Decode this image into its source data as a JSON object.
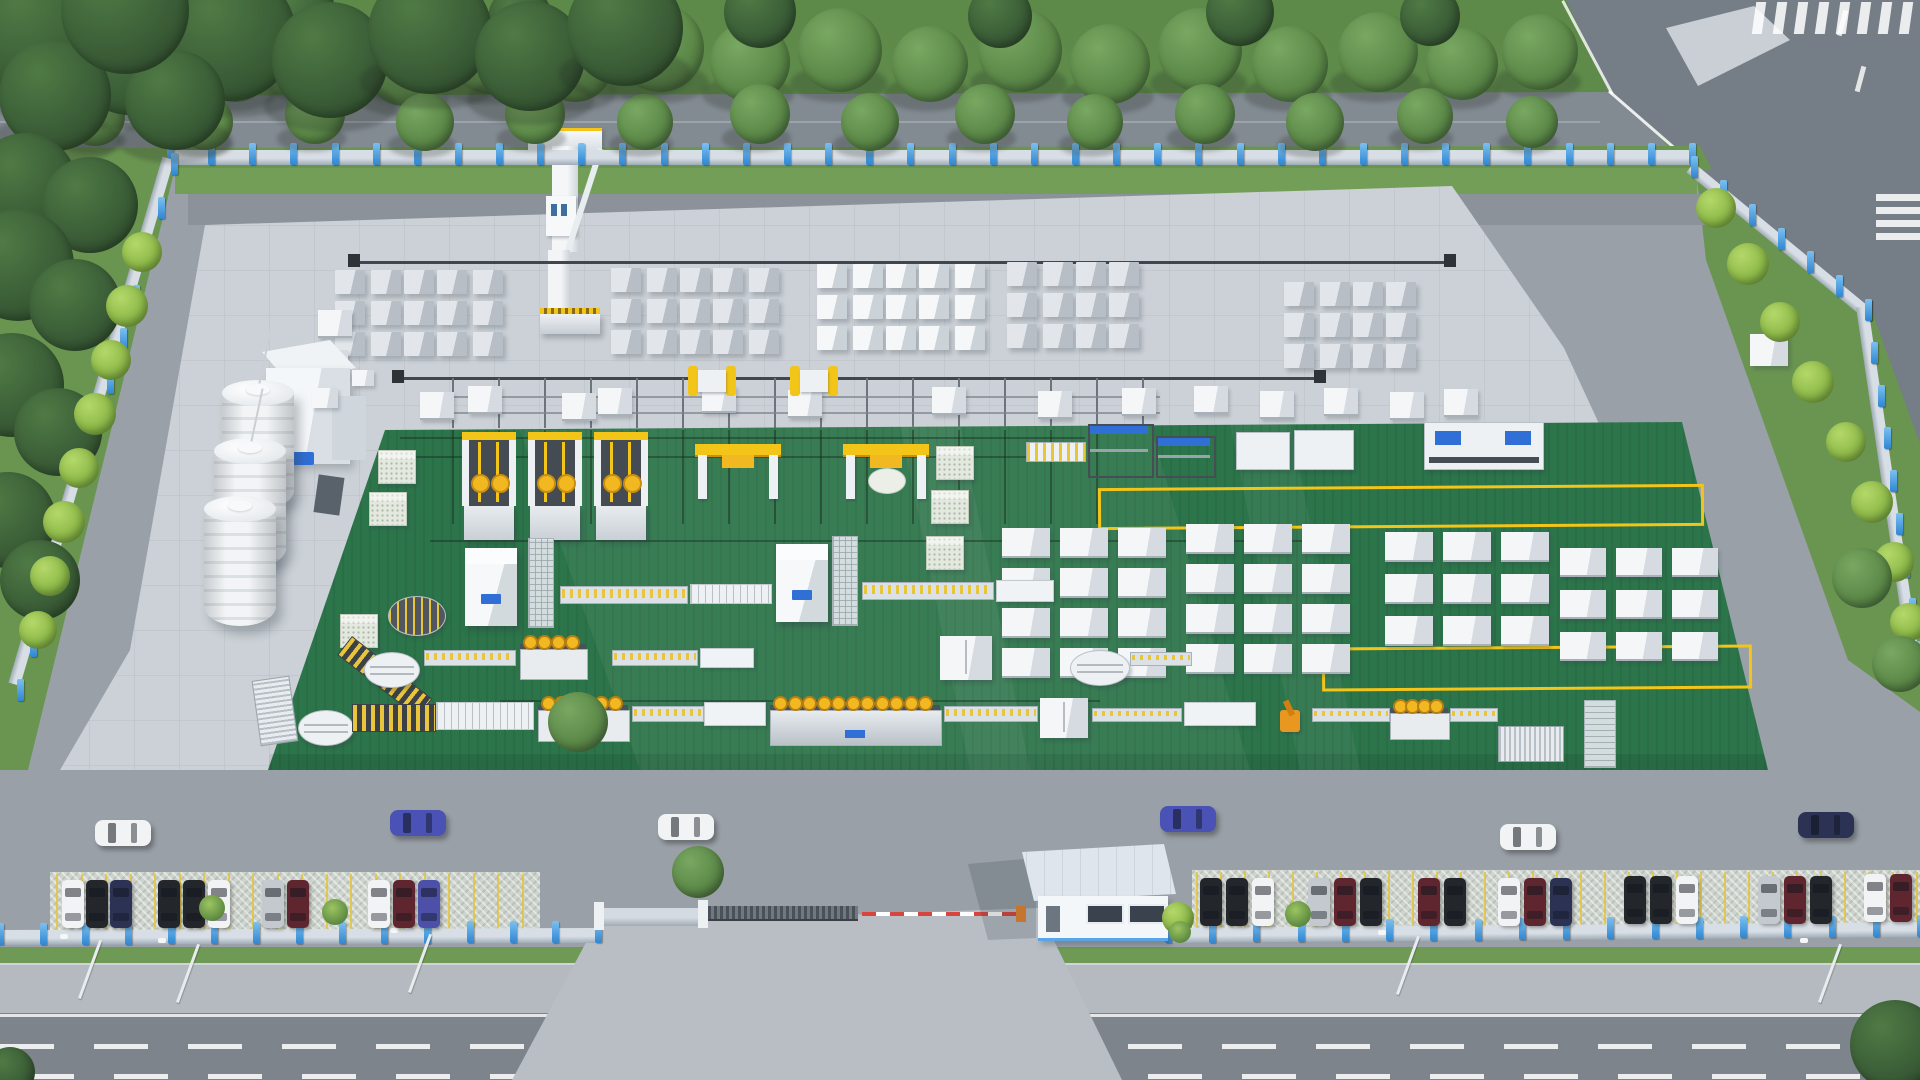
{
  "meta": {
    "description": "aerial 3d render of AAC block factory compound",
    "canvas": {
      "w": 1920,
      "h": 1080
    }
  },
  "palette": {
    "base_apron": "#99a0a7",
    "pad": "#cbd1d6",
    "inner_road": "#8b9299",
    "top_road": "#828a92",
    "wedge_road": "#757d86",
    "public_road": "#7d848c",
    "sidewalk": "#b4bac0",
    "driveway": "#b8bec4",
    "grass": "#6a9551",
    "grass_strip": "#739e57",
    "green_floor": "#2c744a",
    "green_stripe": "rgba(0,0,0,0.06)",
    "yellow": "#f2c518",
    "yellow_dark": "#c98f0e",
    "machine_white": "#eef1f4",
    "machine_side": "#c9d0d6",
    "block_gray_top": "#e2e6ea",
    "block_gray_side": "#b7bec6",
    "block_white_top": "#f5f7f8",
    "block_white_side": "#ccd3d8",
    "logo_blue": "#2f6fd6",
    "post_blue": "#3f98e2",
    "fence_wall": "#d3dae1",
    "dark_rail": "#41464c",
    "barrier_red": "#d8453e",
    "roof": "#dfe5ec",
    "tree": {
      "dark": {
        "l": "#4f7a45",
        "b": "#3b5e37",
        "e": "#2c472a"
      },
      "mid": {
        "l": "#79a862",
        "b": "#5d8a49",
        "e": "#44683a"
      },
      "bright": {
        "l": "#b4d86a",
        "b": "#8fbb4a",
        "e": "#6d9a3a"
      }
    },
    "car": {
      "white": "#f1f3f5",
      "black": "#23272c",
      "navy": "#2c3254",
      "silver": "#c3c9ce",
      "maroon": "#5f2630",
      "violet": "#4c50a8",
      "blue": "#4a52b5"
    }
  },
  "scene": {
    "trees": [
      [
        150,
        52,
        42,
        "mid"
      ],
      [
        235,
        64,
        38,
        "mid"
      ],
      [
        320,
        50,
        44,
        "mid"
      ],
      [
        405,
        66,
        40,
        "mid"
      ],
      [
        490,
        52,
        42,
        "mid"
      ],
      [
        575,
        64,
        38,
        "mid"
      ],
      [
        660,
        48,
        44,
        "mid"
      ],
      [
        750,
        62,
        40,
        "mid"
      ],
      [
        840,
        50,
        42,
        "mid"
      ],
      [
        930,
        64,
        38,
        "mid"
      ],
      [
        1020,
        50,
        42,
        "mid"
      ],
      [
        1110,
        64,
        40,
        "mid"
      ],
      [
        1200,
        50,
        42,
        "mid"
      ],
      [
        1290,
        64,
        38,
        "mid"
      ],
      [
        1378,
        52,
        40,
        "mid"
      ],
      [
        1462,
        64,
        36,
        "mid"
      ],
      [
        1540,
        52,
        38,
        "mid"
      ],
      [
        95,
        116,
        30,
        "mid"
      ],
      [
        205,
        122,
        28,
        "mid"
      ],
      [
        315,
        114,
        30,
        "mid"
      ],
      [
        425,
        122,
        29,
        "mid"
      ],
      [
        535,
        114,
        30,
        "mid"
      ],
      [
        645,
        122,
        28,
        "mid"
      ],
      [
        760,
        114,
        30,
        "mid"
      ],
      [
        870,
        122,
        29,
        "mid"
      ],
      [
        985,
        114,
        30,
        "mid"
      ],
      [
        1095,
        122,
        28,
        "mid"
      ],
      [
        1205,
        114,
        30,
        "mid"
      ],
      [
        1315,
        122,
        29,
        "mid"
      ],
      [
        1425,
        116,
        28,
        "mid"
      ],
      [
        1532,
        122,
        26,
        "mid"
      ],
      [
        300,
        14,
        36,
        "dark"
      ],
      [
        520,
        18,
        32,
        "dark"
      ],
      [
        760,
        12,
        36,
        "dark"
      ],
      [
        1000,
        16,
        32,
        "dark"
      ],
      [
        1240,
        12,
        34,
        "dark"
      ],
      [
        1430,
        16,
        30,
        "dark"
      ],
      [
        40,
        30,
        70,
        "dark"
      ],
      [
        130,
        55,
        60,
        "dark"
      ],
      [
        230,
        35,
        66,
        "dark"
      ],
      [
        330,
        60,
        58,
        "dark"
      ],
      [
        430,
        32,
        62,
        "dark"
      ],
      [
        530,
        56,
        55,
        "dark"
      ],
      [
        625,
        28,
        58,
        "dark"
      ],
      [
        55,
        95,
        56,
        "dark"
      ],
      [
        175,
        100,
        50,
        "dark"
      ],
      [
        125,
        10,
        64,
        "dark"
      ],
      [
        25,
        185,
        52,
        "dark"
      ],
      [
        90,
        205,
        48,
        "dark"
      ],
      [
        18,
        265,
        56,
        "dark"
      ],
      [
        75,
        305,
        46,
        "dark"
      ],
      [
        12,
        385,
        52,
        "dark"
      ],
      [
        58,
        432,
        44,
        "dark"
      ],
      [
        8,
        520,
        48,
        "dark"
      ],
      [
        40,
        580,
        40,
        "dark"
      ],
      [
        142,
        252,
        20,
        "bright"
      ],
      [
        127,
        306,
        21,
        "bright"
      ],
      [
        111,
        360,
        20,
        "bright"
      ],
      [
        95,
        414,
        21,
        "bright"
      ],
      [
        79,
        468,
        20,
        "bright"
      ],
      [
        64,
        522,
        21,
        "bright"
      ],
      [
        50,
        576,
        20,
        "bright"
      ],
      [
        38,
        630,
        19,
        "bright"
      ],
      [
        1716,
        208,
        20,
        "bright"
      ],
      [
        1748,
        264,
        21,
        "bright"
      ],
      [
        1780,
        322,
        20,
        "bright"
      ],
      [
        1813,
        382,
        21,
        "bright"
      ],
      [
        1846,
        442,
        20,
        "bright"
      ],
      [
        1872,
        502,
        21,
        "bright"
      ],
      [
        1894,
        562,
        20,
        "bright"
      ],
      [
        1909,
        622,
        19,
        "bright"
      ],
      [
        1862,
        578,
        30,
        "mid"
      ],
      [
        1900,
        664,
        28,
        "mid"
      ],
      [
        698,
        872,
        26,
        "mid"
      ],
      [
        578,
        722,
        30,
        "mid"
      ],
      [
        1178,
        918,
        16,
        "bright"
      ],
      [
        1895,
        1045,
        45,
        "dark"
      ],
      [
        10,
        1072,
        25,
        "dark"
      ]
    ],
    "bushes": [
      [
        212,
        908,
        13
      ],
      [
        335,
        912,
        13
      ],
      [
        1298,
        914,
        13
      ],
      [
        1180,
        932,
        11
      ]
    ],
    "fences": [
      {
        "x1": 170,
        "y1": 150,
        "x2": 1692,
        "y2": 150,
        "n": 37,
        "h": 15
      },
      {
        "x1": 174,
        "y1": 160,
        "x2": 20,
        "y2": 686,
        "n": 12,
        "h": 12
      },
      {
        "x1": 1694,
        "y1": 163,
        "x2": 1868,
        "y2": 306,
        "n": 6,
        "h": 12
      },
      {
        "x1": 1868,
        "y1": 306,
        "x2": 1918,
        "y2": 648,
        "n": 8,
        "h": 12
      },
      {
        "x1": 0,
        "y1": 930,
        "x2": 598,
        "y2": 928,
        "n": 14,
        "h": 15
      },
      {
        "x1": 1168,
        "y1": 928,
        "x2": 1920,
        "y2": 922,
        "n": 17,
        "h": 15
      }
    ],
    "crane_rails": [
      [
        352,
        261,
        1452
      ],
      [
        396,
        377,
        1322
      ]
    ],
    "rail_buffers": [
      [
        348,
        254
      ],
      [
        1444,
        254
      ],
      [
        392,
        370
      ],
      [
        1314,
        370
      ]
    ],
    "sidings_v": {
      "x1": 452,
      "step": 46,
      "n": 16,
      "y1": 378,
      "y2": 428
    },
    "green_rails_v": {
      "x1": 452,
      "step": 46,
      "n": 15,
      "y1": 430,
      "y2": 524
    },
    "sidings_h": [
      [
        440,
        396,
        720
      ],
      [
        440,
        412,
        720
      ]
    ],
    "green_rails_h": [
      [
        400,
        437,
        685
      ],
      [
        400,
        456,
        685
      ],
      [
        430,
        540,
        900
      ],
      [
        500,
        700,
        600
      ]
    ],
    "clusters": [
      {
        "x": 336,
        "y": 270,
        "cols": 5,
        "rows": 3,
        "t": "g"
      },
      {
        "x": 612,
        "y": 268,
        "cols": 5,
        "rows": 3,
        "t": "g"
      },
      {
        "x": 818,
        "y": 264,
        "cols": 5,
        "rows": 3,
        "t": "w"
      },
      {
        "x": 1008,
        "y": 262,
        "cols": 4,
        "rows": 3,
        "t": "g"
      },
      {
        "x": 1285,
        "y": 282,
        "cols": 4,
        "rows": 3,
        "t": "g"
      }
    ],
    "molds": [
      [
        420,
        392
      ],
      [
        468,
        386
      ],
      [
        562,
        393
      ],
      [
        598,
        388
      ],
      [
        702,
        385
      ],
      [
        788,
        390
      ],
      [
        932,
        387
      ],
      [
        1038,
        391
      ],
      [
        1122,
        388
      ],
      [
        1194,
        386
      ],
      [
        1260,
        391
      ],
      [
        1324,
        388
      ],
      [
        1390,
        392
      ],
      [
        1444,
        389
      ],
      [
        318,
        310
      ],
      [
        314,
        350
      ]
    ],
    "transfer_carts": [
      [
        688,
        360
      ],
      [
        790,
        360
      ]
    ],
    "box_grids": [
      {
        "x": 1002,
        "y": 528,
        "cols": 3,
        "rows": 4,
        "dx": 58,
        "dy": 40,
        "w": 48,
        "h": 28
      },
      {
        "x": 1186,
        "y": 524,
        "cols": 3,
        "rows": 4,
        "dx": 58,
        "dy": 40,
        "w": 48,
        "h": 28
      },
      {
        "x": 1385,
        "y": 532,
        "cols": 3,
        "rows": 3,
        "dx": 58,
        "dy": 42,
        "w": 48,
        "h": 28
      },
      {
        "x": 1560,
        "y": 548,
        "cols": 3,
        "rows": 3,
        "dx": 56,
        "dy": 42,
        "w": 46,
        "h": 27
      }
    ],
    "yellow_rects": [
      [
        1098,
        486,
        600,
        36
      ],
      [
        1322,
        646,
        424,
        38
      ]
    ],
    "cakes": [
      [
        378,
        450
      ],
      [
        369,
        492
      ],
      [
        936,
        446
      ],
      [
        931,
        490
      ],
      [
        926,
        536
      ],
      [
        340,
        614
      ]
    ],
    "tilters": [
      [
        462,
        432
      ],
      [
        528,
        432
      ],
      [
        594,
        432
      ]
    ],
    "gantries": [
      {
        "x": 695,
        "y": 444,
        "roll": false
      },
      {
        "x": 843,
        "y": 444,
        "roll": true
      }
    ],
    "blue_machines": [
      {
        "x": 1088,
        "y": 424,
        "w": 62,
        "h": 50,
        "k": "frame"
      },
      {
        "x": 1156,
        "y": 436,
        "w": 56,
        "h": 38,
        "k": "frame"
      },
      {
        "x": 1236,
        "y": 432,
        "w": 52,
        "h": 36,
        "k": "table"
      },
      {
        "x": 1294,
        "y": 430,
        "w": 58,
        "h": 38,
        "k": "table"
      },
      {
        "x": 1424,
        "y": 422,
        "w": 118,
        "h": 46,
        "k": "bigblue"
      }
    ],
    "ytable": [
      1026,
      442,
      58,
      18
    ],
    "kgoa_cubes": [
      [
        465,
        548
      ],
      [
        776,
        544
      ]
    ],
    "towers": [
      [
        528,
        538
      ],
      [
        832,
        536
      ]
    ],
    "conveyors": [
      {
        "segs": [
          [
            "turnY",
            388,
            596,
            56,
            38
          ],
          [
            "hatchR",
            352,
            636,
            100,
            22
          ],
          [
            "roller",
            560,
            586,
            126,
            16
          ],
          [
            "slat",
            690,
            584,
            80,
            18
          ],
          [
            "roller",
            862,
            582,
            130,
            16
          ],
          [
            "table",
            996,
            580,
            56,
            20
          ]
        ]
      },
      {
        "segs": [
          [
            "turn",
            364,
            652,
            54,
            34
          ],
          [
            "roller",
            424,
            650,
            90,
            14
          ],
          [
            "spool",
            520,
            630,
            66,
            48
          ],
          [
            "tower",
            590,
            640,
            18,
            50
          ],
          [
            "roller",
            612,
            650,
            84,
            14
          ],
          [
            "table",
            700,
            648,
            52,
            18
          ],
          [
            "cab",
            940,
            636,
            52,
            44
          ],
          [
            "turn",
            1070,
            650,
            58,
            34
          ],
          [
            "roller",
            1130,
            652,
            60,
            12
          ]
        ]
      },
      {
        "segs": [
          [
            "rackV",
            256,
            678,
            36,
            64
          ],
          [
            "turn",
            298,
            710,
            54,
            34
          ],
          [
            "hatchH",
            352,
            704,
            82,
            26
          ],
          [
            "slat",
            436,
            702,
            96,
            26
          ],
          [
            "spool",
            538,
            690,
            90,
            50
          ],
          [
            "roller",
            632,
            706,
            70,
            14
          ],
          [
            "table",
            704,
            702,
            60,
            22
          ],
          [
            "spoolbig",
            770,
            688,
            170,
            56
          ],
          [
            "roller",
            944,
            706,
            92,
            14
          ],
          [
            "cab",
            1040,
            698,
            48,
            40
          ],
          [
            "roller",
            1092,
            708,
            88,
            12
          ],
          [
            "table",
            1184,
            702,
            70,
            22
          ],
          [
            "robot",
            1272,
            700,
            38,
            36
          ],
          [
            "roller",
            1312,
            708,
            76,
            12
          ],
          [
            "spool",
            1390,
            696,
            58,
            42
          ],
          [
            "roller",
            1450,
            708,
            46,
            12
          ],
          [
            "rack",
            1498,
            726,
            64,
            34
          ],
          [
            "towerV",
            1584,
            700,
            30,
            66
          ]
        ]
      }
    ],
    "silos": [
      [
        222,
        392
      ],
      [
        214,
        450
      ],
      [
        204,
        508
      ]
    ],
    "cars_moving": [
      [
        95,
        820,
        "white"
      ],
      [
        390,
        810,
        "blue"
      ],
      [
        658,
        814,
        "white"
      ],
      [
        1160,
        806,
        "blue"
      ],
      [
        1500,
        824,
        "white"
      ],
      [
        1798,
        812,
        "navy"
      ]
    ],
    "cars_parked": [
      [
        62,
        880,
        "white"
      ],
      [
        86,
        880,
        "black"
      ],
      [
        110,
        880,
        "navy"
      ],
      [
        158,
        880,
        "black"
      ],
      [
        183,
        880,
        "black"
      ],
      [
        208,
        880,
        "white"
      ],
      [
        262,
        880,
        "silver"
      ],
      [
        287,
        880,
        "maroon"
      ],
      [
        368,
        880,
        "white"
      ],
      [
        393,
        880,
        "maroon"
      ],
      [
        418,
        880,
        "violet"
      ],
      [
        1200,
        878,
        "black"
      ],
      [
        1226,
        878,
        "black"
      ],
      [
        1252,
        878,
        "white"
      ],
      [
        1308,
        878,
        "silver"
      ],
      [
        1334,
        878,
        "maroon"
      ],
      [
        1360,
        878,
        "black"
      ],
      [
        1418,
        878,
        "maroon"
      ],
      [
        1444,
        878,
        "black"
      ],
      [
        1498,
        878,
        "white"
      ],
      [
        1524,
        878,
        "maroon"
      ],
      [
        1550,
        878,
        "navy"
      ],
      [
        1624,
        876,
        "black"
      ],
      [
        1650,
        876,
        "black"
      ],
      [
        1676,
        876,
        "white"
      ],
      [
        1758,
        876,
        "silver"
      ],
      [
        1784,
        876,
        "maroon"
      ],
      [
        1810,
        876,
        "black"
      ],
      [
        1864,
        874,
        "white"
      ],
      [
        1890,
        874,
        "maroon"
      ]
    ],
    "stall_bands": [
      {
        "x1": 56,
        "x2": 536,
        "y": 874,
        "h": 60,
        "step": 24.5
      },
      {
        "x1": 1196,
        "x2": 1916,
        "y": 872,
        "h": 60,
        "step": 24
      }
    ],
    "lamps": [
      [
        60,
        996
      ],
      [
        158,
        1000
      ],
      [
        390,
        990
      ],
      [
        1378,
        992
      ],
      [
        1800,
        1000
      ]
    ],
    "road_dashes": {
      "rows": [
        1044,
        1074
      ],
      "w": 54,
      "gap": 40,
      "h": 5
    },
    "crosswalk_a": {
      "x": 1754,
      "y": 2,
      "n": 8,
      "step": 21,
      "w": 10,
      "h": 32
    },
    "crosswalk_b": {
      "x": 1876,
      "y": 194,
      "n": 4,
      "step": 13,
      "w": 46,
      "h": 7
    },
    "wedge_dashes": [
      [
        1840,
        10
      ],
      [
        1858,
        66
      ]
    ]
  }
}
